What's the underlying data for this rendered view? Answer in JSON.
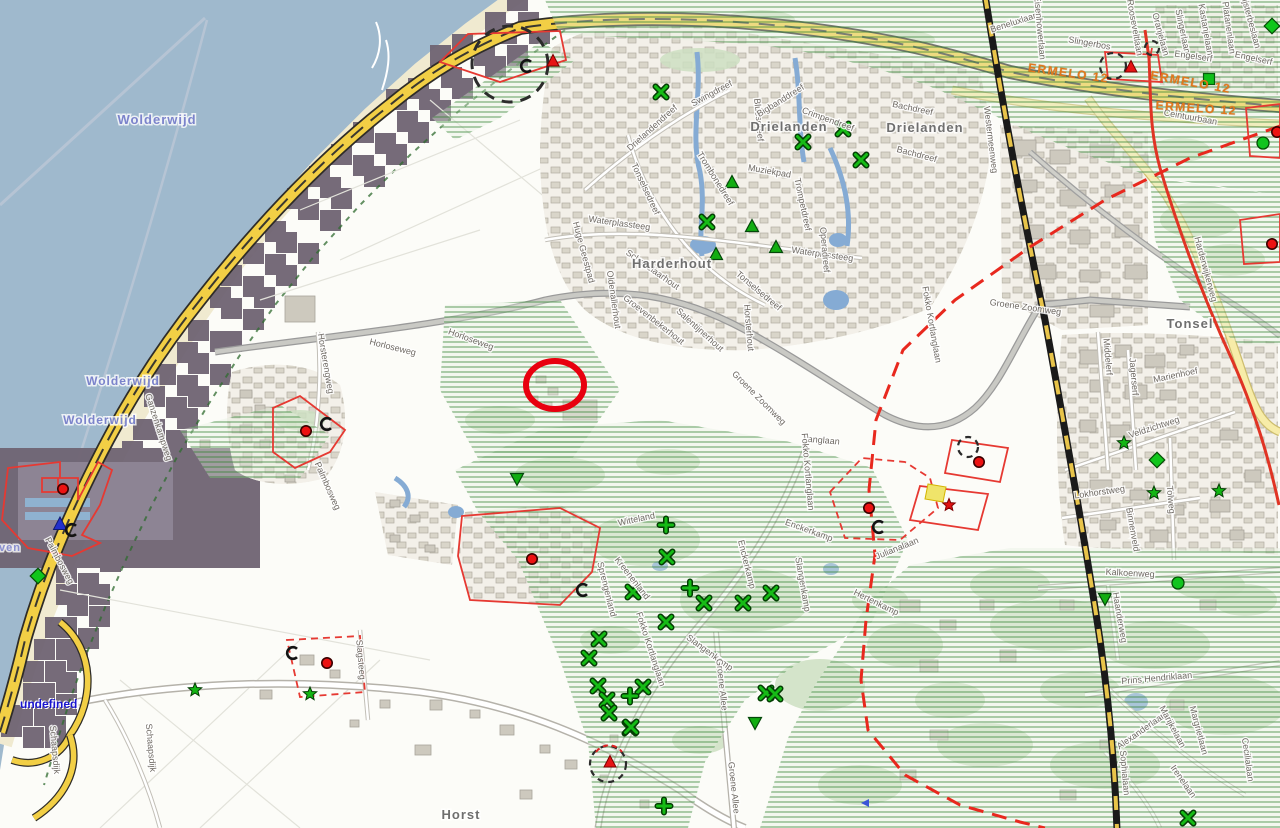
{
  "map": {
    "status_text": "undefined",
    "colors": {
      "water": "#9fb9cd",
      "beach": "#f0ead0",
      "overlay_band": "#6f6473",
      "highway": "#f2cf45",
      "pale_road": "#f7eca8",
      "railway_dash": "#e8c44a",
      "hatch_line": "#3f8f3f",
      "boundary": "#e8281e",
      "parcel": "#e63932",
      "highlight": "#e8000f",
      "red_road": "#e03424",
      "sign_text": "#e2771c"
    },
    "place_labels": [
      {
        "text": "Wolderwijd",
        "x": 157,
        "y": 124,
        "size": 13,
        "color": "#7b83cb"
      },
      {
        "text": "Wolderwijd",
        "x": 123,
        "y": 385,
        "size": 12,
        "color": "#7b83cb"
      },
      {
        "text": "Wolderwijd",
        "x": 100,
        "y": 424,
        "size": 12,
        "color": "#7b83cb"
      },
      {
        "text": "ven",
        "x": 10,
        "y": 551,
        "size": 11,
        "color": "#8a8fd0"
      },
      {
        "text": "Drielanden",
        "x": 789,
        "y": 131,
        "size": 13,
        "color": "#6f6f6f"
      },
      {
        "text": "Drielanden",
        "x": 925,
        "y": 132,
        "size": 13,
        "color": "#6f6f6f"
      },
      {
        "text": "Harderhout",
        "x": 672,
        "y": 268,
        "size": 13,
        "color": "#6f6f6f"
      },
      {
        "text": "Tonsel",
        "x": 1190,
        "y": 328,
        "size": 13,
        "color": "#6f6f6f"
      },
      {
        "text": "Horst",
        "x": 461,
        "y": 819,
        "size": 13,
        "color": "#6f6f6f"
      }
    ],
    "road_sign_labels": [
      {
        "text": "ERMELO 12",
        "x": 1068,
        "y": 77,
        "rot": 8
      },
      {
        "text": "ERMELO 12",
        "x": 1190,
        "y": 86,
        "rot": 10
      },
      {
        "text": "ERMELO 12",
        "x": 1196,
        "y": 112,
        "rot": 4
      }
    ],
    "street_labels": [
      [
        "Palmbosweg",
        325,
        487,
        66
      ],
      [
        "Palmbosweg",
        57,
        562,
        62
      ],
      [
        "Ganzenkampweg",
        156,
        428,
        72
      ],
      [
        "Horsterengweg",
        323,
        364,
        80
      ],
      [
        "Horloseweg",
        392,
        350,
        14
      ],
      [
        "Horloseweg",
        470,
        342,
        20
      ],
      [
        "Huge Geestpad",
        581,
        253,
        75
      ],
      [
        "Oldenallerhout",
        611,
        300,
        82
      ],
      [
        "Schaffelaarhout",
        651,
        272,
        35
      ],
      [
        "Groevenbekerhout",
        652,
        322,
        38
      ],
      [
        "Salentijnerhout",
        698,
        332,
        42
      ],
      [
        "Horsterhout",
        746,
        328,
        85
      ],
      [
        "Tonselsedreef",
        643,
        190,
        65
      ],
      [
        "Tonselsedreef",
        757,
        293,
        40
      ],
      [
        "Trombonedreef",
        713,
        180,
        58
      ],
      [
        "Muziekpad",
        769,
        174,
        10
      ],
      [
        "Waterplassteeg",
        619,
        226,
        8
      ],
      [
        "Waterplassteeg",
        822,
        257,
        8
      ],
      [
        "Drielandendreef",
        654,
        130,
        -42
      ],
      [
        "Swingdreef",
        713,
        96,
        -28
      ],
      [
        "Bluesdreef",
        756,
        120,
        85
      ],
      [
        "Bigbanddreef",
        782,
        103,
        -32
      ],
      [
        "Crimpendreef",
        827,
        122,
        20
      ],
      [
        "Bachdreef",
        912,
        111,
        12
      ],
      [
        "Bachdreef",
        916,
        157,
        15
      ],
      [
        "Operadreef",
        822,
        250,
        85
      ],
      [
        "Trompetdreef",
        800,
        205,
        78
      ],
      [
        "Beneluxlaan",
        1015,
        25,
        -18
      ],
      [
        "Eisenhowerlaan",
        1037,
        28,
        85
      ],
      [
        "Slingerbos",
        1089,
        46,
        10
      ],
      [
        "Rooseveltlaan",
        1132,
        28,
        80
      ],
      [
        "Oranjelaan",
        1158,
        35,
        75
      ],
      [
        "Slingerlaan",
        1180,
        32,
        78
      ],
      [
        "Kastanjelaan",
        1203,
        30,
        80
      ],
      [
        "Platanenlaan",
        1226,
        28,
        82
      ],
      [
        "Lijsterbeslaan",
        1248,
        22,
        75
      ],
      [
        "Engelserf",
        1193,
        59,
        8
      ],
      [
        "Engelserf",
        1253,
        61,
        12
      ],
      [
        "Ceintuurbaan",
        1190,
        120,
        10
      ],
      [
        "Westermeenweg",
        988,
        140,
        83
      ],
      [
        "Groene Zoomweg",
        757,
        400,
        45
      ],
      [
        "Groene Zoomweg",
        1025,
        310,
        8
      ],
      [
        "Langlaan",
        821,
        443,
        5
      ],
      [
        "Fokko Kortlanglaan",
        805,
        472,
        85
      ],
      [
        "Fokko Kortlanglaan",
        929,
        325,
        80
      ],
      [
        "Fokko Kortlanglaan",
        648,
        650,
        72
      ],
      [
        "Julianalaan",
        898,
        551,
        -22
      ],
      [
        "Witteland",
        637,
        522,
        -12
      ],
      [
        "Kreenenland",
        630,
        580,
        52
      ],
      [
        "Sprengenland",
        604,
        590,
        76
      ],
      [
        "Enckerkamp",
        808,
        533,
        20
      ],
      [
        "Enckerkamp",
        744,
        565,
        76
      ],
      [
        "Slangenkamp",
        708,
        655,
        36
      ],
      [
        "Slangenkamp",
        800,
        585,
        80
      ],
      [
        "Hertenkamp",
        875,
        605,
        26
      ],
      [
        "Groene Allee",
        719,
        685,
        84
      ],
      [
        "Groene Allee",
        731,
        788,
        84
      ],
      [
        "Kalkoenweg",
        1130,
        576,
        3
      ],
      [
        "Haanderweg",
        1117,
        618,
        80
      ],
      [
        "Prins Hendriklaan",
        1157,
        681,
        -5
      ],
      [
        "Alexanderlaan",
        1143,
        733,
        -35
      ],
      [
        "Marijkelaan",
        1170,
        728,
        62
      ],
      [
        "Margrietlaan",
        1196,
        731,
        75
      ],
      [
        "Cecilialaan",
        1245,
        760,
        82
      ],
      [
        "Sophialaan",
        1122,
        773,
        85
      ],
      [
        "Irenelaan",
        1181,
        783,
        55
      ],
      [
        "Veldzichtweg",
        1155,
        430,
        -18
      ],
      [
        "Tolweg",
        1168,
        500,
        85
      ],
      [
        "Lokhorstweg",
        1100,
        495,
        -8
      ],
      [
        "Binnenveld",
        1130,
        530,
        80
      ],
      [
        "Middelerf",
        1105,
        357,
        85
      ],
      [
        "Jagerserf",
        1131,
        377,
        85
      ],
      [
        "Marienhoef",
        1176,
        378,
        -12
      ],
      [
        "Harderwijkerweg",
        1203,
        270,
        75
      ],
      [
        "Slagsteeg",
        358,
        660,
        85
      ],
      [
        "Schaapsdijk",
        52,
        750,
        85
      ],
      [
        "Schaapsdijk",
        148,
        748,
        85
      ]
    ],
    "markers": {
      "red_dot": [
        [
          63,
          489
        ],
        [
          306,
          431
        ],
        [
          532,
          559
        ],
        [
          327,
          663
        ],
        [
          869,
          508
        ],
        [
          979,
          462
        ],
        [
          1277,
          132
        ],
        [
          1272,
          244
        ]
      ],
      "red_triangle": [
        [
          553,
          61
        ],
        [
          1131,
          67
        ],
        [
          610,
          762
        ]
      ],
      "red_star": [
        [
          949,
          505
        ]
      ],
      "blue_triangle": [
        [
          60,
          524
        ]
      ],
      "blue_arrow": [
        [
          866,
          803
        ]
      ],
      "c_arc": [
        [
          327,
          424
        ],
        [
          583,
          590
        ],
        [
          293,
          653
        ],
        [
          879,
          527
        ],
        [
          72,
          530
        ],
        [
          527,
          66
        ]
      ],
      "green_x": [
        [
          661,
          92
        ],
        [
          803,
          142
        ],
        [
          843,
          129
        ],
        [
          861,
          160
        ],
        [
          707,
          222
        ],
        [
          667,
          557
        ],
        [
          633,
          592
        ],
        [
          704,
          603
        ],
        [
          743,
          603
        ],
        [
          771,
          593
        ],
        [
          666,
          622
        ],
        [
          599,
          639
        ],
        [
          589,
          658
        ],
        [
          598,
          686
        ],
        [
          643,
          687
        ],
        [
          607,
          700
        ],
        [
          609,
          713
        ],
        [
          630,
          728
        ],
        [
          766,
          693
        ],
        [
          775,
          694
        ],
        [
          631,
          727
        ],
        [
          1188,
          818
        ]
      ],
      "green_plus": [
        [
          690,
          588
        ],
        [
          666,
          525
        ],
        [
          630,
          696
        ],
        [
          664,
          806
        ]
      ],
      "green_star": [
        [
          195,
          690
        ],
        [
          310,
          694
        ],
        [
          1124,
          443
        ],
        [
          1154,
          493
        ],
        [
          1219,
          491
        ]
      ],
      "green_diamond": [
        [
          1272,
          26
        ],
        [
          38,
          576
        ],
        [
          1157,
          460
        ]
      ],
      "green_square": [
        [
          1209,
          79
        ]
      ],
      "green_circle": [
        [
          1263,
          143
        ],
        [
          1178,
          583
        ]
      ],
      "green_triangle_up": [
        [
          732,
          182
        ],
        [
          752,
          226
        ],
        [
          716,
          254
        ],
        [
          776,
          247
        ]
      ],
      "green_triangle_down": [
        [
          517,
          479
        ],
        [
          755,
          723
        ],
        [
          1105,
          599
        ]
      ]
    },
    "annotations": {
      "highlight_ellipse": {
        "cx": 555,
        "cy": 385,
        "rx": 29,
        "ry": 24,
        "stroke_width": 6
      },
      "dashed_circles": [
        {
          "cx": 510,
          "cy": 64,
          "r": 38
        },
        {
          "cx": 1113,
          "cy": 66,
          "r": 13
        },
        {
          "cx": 1152,
          "cy": 48,
          "r": 7
        },
        {
          "cx": 968,
          "cy": 447,
          "r": 10
        },
        {
          "cx": 608,
          "cy": 764,
          "r": 18
        }
      ],
      "highlighted_building": {
        "x": 928,
        "y": 484,
        "note": "yellow highlighted parcel building"
      }
    }
  }
}
